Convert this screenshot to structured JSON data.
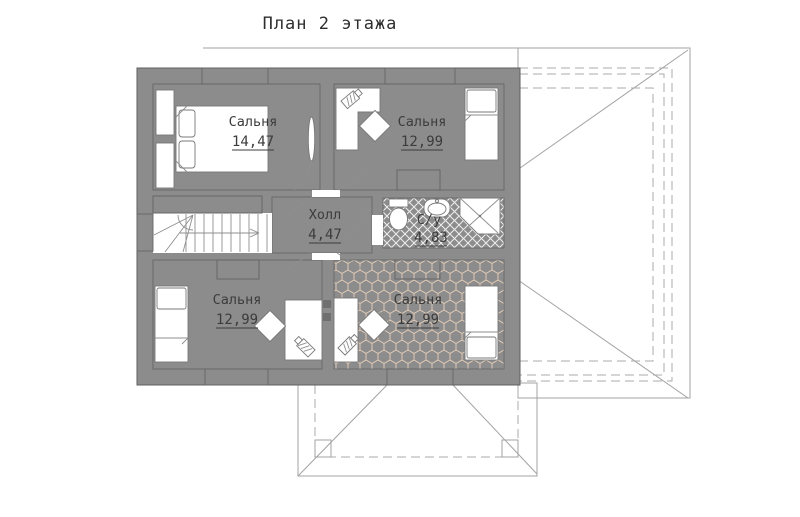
{
  "title": "План 2 этажа",
  "rooms": {
    "bedroom_tl": {
      "label": "Сальня",
      "area": "14,47"
    },
    "bedroom_tr": {
      "label": "Сальня",
      "area": "12,99"
    },
    "hall": {
      "label": "Холл",
      "area": "4,47"
    },
    "bathroom": {
      "label": "С/у",
      "area": "4,83"
    },
    "bedroom_bl": {
      "label": "Сальня",
      "area": "12,99"
    },
    "bedroom_br": {
      "label": "Сальня",
      "area": "12,99"
    }
  },
  "colors": {
    "wall": "#8c8c8c",
    "cream": "#f6f2da",
    "green": "#e4eed9",
    "lavender": "#e9e7f8",
    "teal": "#cfe9e4",
    "peach": "#f5e3d3",
    "white": "#ffffff"
  }
}
